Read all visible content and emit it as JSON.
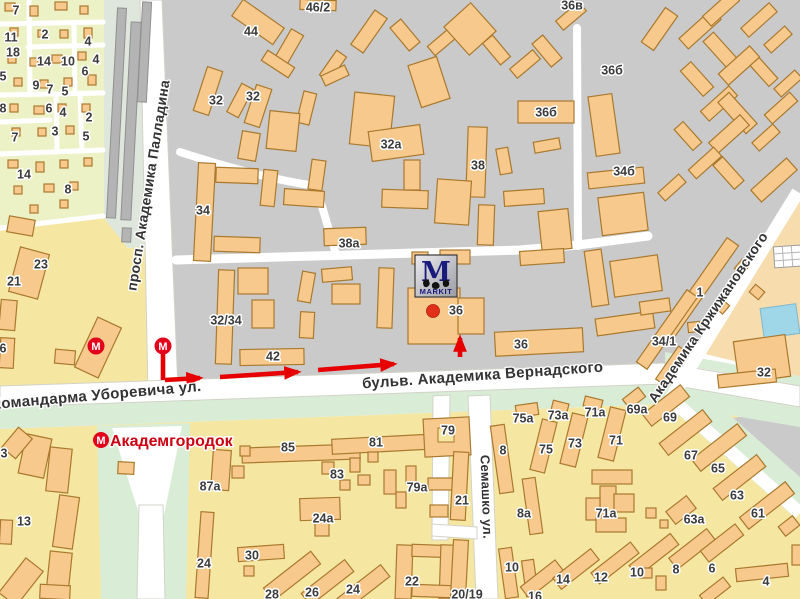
{
  "map": {
    "logo": {
      "letter": "M",
      "text": "MARKIT"
    },
    "metro": {
      "symbol": "М",
      "stations": [
        {
          "x": 96,
          "y": 346
        },
        {
          "x": 163,
          "y": 346
        }
      ],
      "named_station": {
        "x": 101,
        "y": 440,
        "label": "Академгородок"
      }
    },
    "destination_dot": {
      "x": 433,
      "y": 311
    },
    "route": {
      "segments": [
        {
          "x1": 163,
          "y1": 351,
          "x2": 163,
          "y2": 380,
          "arrow": false
        },
        {
          "x1": 165,
          "y1": 380,
          "x2": 200,
          "y2": 378,
          "arrow": true
        },
        {
          "x1": 220,
          "y1": 377,
          "x2": 298,
          "y2": 372,
          "arrow": true
        },
        {
          "x1": 318,
          "y1": 370,
          "x2": 394,
          "y2": 364,
          "arrow": true
        },
        {
          "x1": 460,
          "y1": 357,
          "x2": 460,
          "y2": 338,
          "arrow": true
        }
      ]
    },
    "streets": [
      {
        "name": "просп. Академика Палладина",
        "x": 153,
        "y": 186,
        "angle": -81,
        "size": 14
      },
      {
        "name": "Командарма Уборевича ул.",
        "x": 97,
        "y": 400,
        "angle": -5,
        "size": 15
      },
      {
        "name": "бульв. Академика Вернадского",
        "x": 483,
        "y": 380,
        "angle": -4,
        "size": 15
      },
      {
        "name": "Семашко ул.",
        "x": 482,
        "y": 497,
        "angle": 88,
        "size": 13
      },
      {
        "name": "Академика Кржижановского",
        "x": 712,
        "y": 320,
        "angle": -56,
        "size": 14
      }
    ],
    "building_labels": [
      {
        "t": "46/2",
        "x": 318,
        "y": 7
      },
      {
        "t": "44",
        "x": 251,
        "y": 31
      },
      {
        "t": "32",
        "x": 216,
        "y": 100
      },
      {
        "t": "32",
        "x": 253,
        "y": 96
      },
      {
        "t": "32а",
        "x": 391,
        "y": 144
      },
      {
        "t": "38",
        "x": 478,
        "y": 165
      },
      {
        "t": "36б",
        "x": 546,
        "y": 112
      },
      {
        "t": "36в",
        "x": 572,
        "y": 5
      },
      {
        "t": "36б",
        "x": 612,
        "y": 70
      },
      {
        "t": "34б",
        "x": 624,
        "y": 171
      },
      {
        "t": "34",
        "x": 203,
        "y": 210
      },
      {
        "t": "38а",
        "x": 349,
        "y": 243
      },
      {
        "t": "32/34",
        "x": 226,
        "y": 320
      },
      {
        "t": "42",
        "x": 273,
        "y": 356
      },
      {
        "t": "36",
        "x": 456,
        "y": 310
      },
      {
        "t": "36",
        "x": 521,
        "y": 344
      },
      {
        "t": "1",
        "x": 700,
        "y": 292
      },
      {
        "t": "34/1",
        "x": 664,
        "y": 341
      },
      {
        "t": "32",
        "x": 764,
        "y": 372
      },
      {
        "t": "7",
        "x": 16,
        "y": 10
      },
      {
        "t": "2",
        "x": 45,
        "y": 34
      },
      {
        "t": "4",
        "x": 88,
        "y": 41
      },
      {
        "t": "11",
        "x": 11,
        "y": 37
      },
      {
        "t": "18",
        "x": 13,
        "y": 52
      },
      {
        "t": "14",
        "x": 44,
        "y": 61
      },
      {
        "t": "10",
        "x": 68,
        "y": 61
      },
      {
        "t": "4",
        "x": 96,
        "y": 59
      },
      {
        "t": "6",
        "x": 85,
        "y": 71
      },
      {
        "t": "5",
        "x": 3,
        "y": 76
      },
      {
        "t": "9",
        "x": 36,
        "y": 85
      },
      {
        "t": "7",
        "x": 50,
        "y": 89
      },
      {
        "t": "5",
        "x": 65,
        "y": 91
      },
      {
        "t": "8",
        "x": 3,
        "y": 108
      },
      {
        "t": "6",
        "x": 49,
        "y": 108
      },
      {
        "t": "4",
        "x": 63,
        "y": 112
      },
      {
        "t": "2",
        "x": 89,
        "y": 117
      },
      {
        "t": "3",
        "x": 55,
        "y": 131
      },
      {
        "t": "7",
        "x": 15,
        "y": 137
      },
      {
        "t": "5",
        "x": 86,
        "y": 136
      },
      {
        "t": "14",
        "x": 24,
        "y": 174
      },
      {
        "t": "8",
        "x": 68,
        "y": 189
      },
      {
        "t": "23",
        "x": 41,
        "y": 264
      },
      {
        "t": "21",
        "x": 14,
        "y": 281
      },
      {
        "t": "6",
        "x": 3,
        "y": 348
      },
      {
        "t": "3",
        "x": 4,
        "y": 453
      },
      {
        "t": "13",
        "x": 24,
        "y": 521
      },
      {
        "t": "85",
        "x": 288,
        "y": 447
      },
      {
        "t": "81",
        "x": 376,
        "y": 442
      },
      {
        "t": "79",
        "x": 448,
        "y": 430
      },
      {
        "t": "83",
        "x": 337,
        "y": 474
      },
      {
        "t": "79а",
        "x": 417,
        "y": 487
      },
      {
        "t": "24а",
        "x": 323,
        "y": 518
      },
      {
        "t": "21",
        "x": 462,
        "y": 500
      },
      {
        "t": "87а",
        "x": 210,
        "y": 486
      },
      {
        "t": "24",
        "x": 204,
        "y": 563
      },
      {
        "t": "30",
        "x": 252,
        "y": 555
      },
      {
        "t": "28",
        "x": 272,
        "y": 594
      },
      {
        "t": "26",
        "x": 312,
        "y": 592
      },
      {
        "t": "24",
        "x": 353,
        "y": 589
      },
      {
        "t": "22",
        "x": 412,
        "y": 581
      },
      {
        "t": "20/19",
        "x": 467,
        "y": 594
      },
      {
        "t": "16",
        "x": 535,
        "y": 596
      },
      {
        "t": "75а",
        "x": 523,
        "y": 418
      },
      {
        "t": "8",
        "x": 503,
        "y": 450
      },
      {
        "t": "8а",
        "x": 524,
        "y": 513
      },
      {
        "t": "10",
        "x": 512,
        "y": 567
      },
      {
        "t": "73а",
        "x": 558,
        "y": 415
      },
      {
        "t": "71а",
        "x": 595,
        "y": 412
      },
      {
        "t": "69а",
        "x": 637,
        "y": 409
      },
      {
        "t": "69",
        "x": 670,
        "y": 417
      },
      {
        "t": "75",
        "x": 546,
        "y": 449
      },
      {
        "t": "73",
        "x": 575,
        "y": 443
      },
      {
        "t": "71",
        "x": 616,
        "y": 440
      },
      {
        "t": "67",
        "x": 691,
        "y": 455
      },
      {
        "t": "65",
        "x": 718,
        "y": 468
      },
      {
        "t": "63",
        "x": 737,
        "y": 495
      },
      {
        "t": "63а",
        "x": 694,
        "y": 519
      },
      {
        "t": "71а",
        "x": 606,
        "y": 513
      },
      {
        "t": "61",
        "x": 758,
        "y": 513
      },
      {
        "t": "14",
        "x": 563,
        "y": 579
      },
      {
        "t": "12",
        "x": 601,
        "y": 577
      },
      {
        "t": "10",
        "x": 637,
        "y": 572
      },
      {
        "t": "8",
        "x": 676,
        "y": 569
      },
      {
        "t": "6",
        "x": 712,
        "y": 568
      },
      {
        "t": "4",
        "x": 766,
        "y": 581
      }
    ],
    "colors": {
      "route_red": "#e60000",
      "metro_red": "#e2001a",
      "station_label_red": "#cc0011",
      "building_fill": "#f8c98c",
      "building_stroke": "#a9792e",
      "zone_gray": "#cacaca",
      "zone_yellow": "#f5e7a2",
      "zone_green_nw": "#edf2c6",
      "zone_peach": "#f7dcae",
      "green_strip": "#d9edd6",
      "tram_bg": "#dfe7dc",
      "tram_fill": "#b4b4b4",
      "pool_blue": "#9fd6e8",
      "logo_navy": "#1b1b7e"
    }
  }
}
